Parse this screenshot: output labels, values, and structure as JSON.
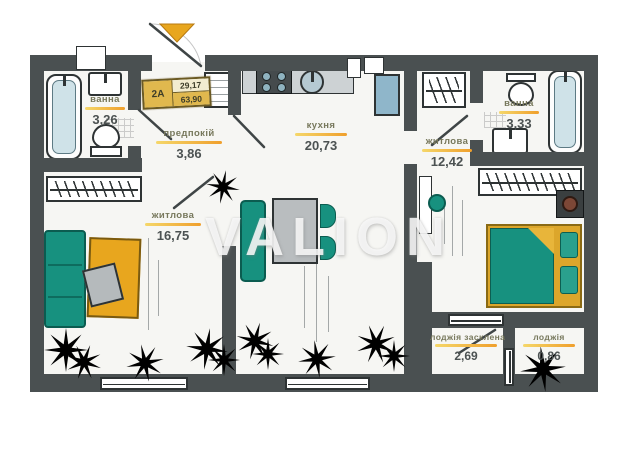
{
  "watermark": "VALION",
  "unit_tag": {
    "code": "2А",
    "living_area": "29,17",
    "total_area": "63,90"
  },
  "rooms": {
    "bathroom_left": {
      "name": "ванна",
      "area": "3,26"
    },
    "hallway": {
      "name": "предпокій",
      "area": "3,86"
    },
    "kitchen": {
      "name": "кухня",
      "area": "20,73"
    },
    "living_room": {
      "name": "житлова",
      "area": "16,75"
    },
    "bedroom": {
      "name": "житлова",
      "area": "12,42"
    },
    "bathroom_right": {
      "name": "ванна",
      "area": "3,33"
    },
    "loggia_glazed": {
      "name": "лоджія засклена",
      "area": "2,69"
    },
    "loggia": {
      "name": "лоджія",
      "area": "0,86"
    }
  },
  "colors": {
    "wall": "#4a5051",
    "teal": "#17917f",
    "yellow": "#e8a61e",
    "underline": "#ef9f2c",
    "label_text": "#77785c",
    "area_text": "#4c5252",
    "plant_fill": "#4c8226",
    "plant_stroke": "#1c330e",
    "watermark": "rgba(250,250,250,0.85)"
  }
}
